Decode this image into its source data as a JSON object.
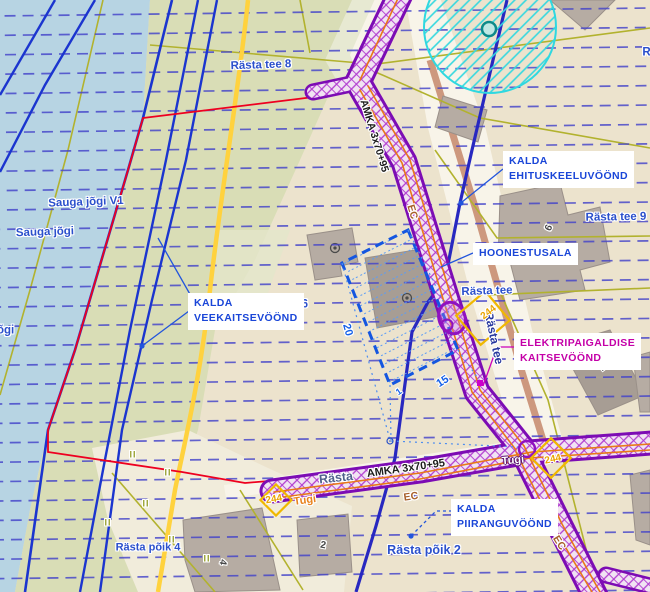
{
  "palette": {
    "water": "#b7d4e3",
    "vegetation": "#d9ddb6",
    "ground": "#ece3cd",
    "road_white": "#f8f4e9",
    "corridor_purple": "#7c0cb4",
    "cable_orange": "#e87818",
    "boundary_red": "#ee0020",
    "zone_line_navy": "#2828c0",
    "parcel_olive": "#b2b22e",
    "main_line_yellow": "#ffd23e",
    "well_zone_cyan": "#2fd8e0",
    "label_blue": "#1a46d8",
    "label_magenta": "#c400a8",
    "contour_blue": "#1b35cf",
    "hoonestusala_blue": "#1456e0"
  },
  "map": {
    "annotations": [
      {
        "id": "kalda-ehituskeeluvoond-label",
        "lines": [
          "KALDA",
          "EHITUSKEELUVÖÖND"
        ],
        "x": 503,
        "y": 151,
        "color": "#1a46d8"
      },
      {
        "id": "hoonestusala-label",
        "lines": [
          "HOONESTUSALA"
        ],
        "x": 473,
        "y": 243,
        "color": "#1a46d8"
      },
      {
        "id": "kalda-veekaitsevoond-label",
        "lines": [
          "KALDA",
          "VEEKAITSEVÖÖND"
        ],
        "x": 188,
        "y": 293,
        "color": "#1a46d8"
      },
      {
        "id": "kalda-piiranguvoond-label",
        "lines": [
          "KALDA",
          "PIIRANGUVÖÖND"
        ],
        "x": 451,
        "y": 499,
        "color": "#1a46d8"
      },
      {
        "id": "elektripaigaldise-kaitsevoond-label",
        "lines": [
          "ELEKTRIPAIGALDISE",
          "KAITSEVÖÖND"
        ],
        "x": 514,
        "y": 333,
        "color": "#c400a8"
      }
    ],
    "place_labels": [
      {
        "id": "rasta-tee-8-label",
        "text": "Rästa tee 8",
        "x": 261,
        "y": 66,
        "rot": -2,
        "size": 11.5,
        "cls": "street"
      },
      {
        "id": "rasta-tee-9-label",
        "text": "Rästa tee 9",
        "x": 616,
        "y": 218,
        "rot": -1,
        "size": 11.5,
        "cls": "street"
      },
      {
        "id": "rasta-tee-clipped-label",
        "text": "Rästa tee",
        "x": 668,
        "y": 53,
        "rot": 0,
        "size": 11.5,
        "cls": "street"
      },
      {
        "id": "sauga-jogi-v1-label",
        "text": "Sauga jõgi V1",
        "x": 86,
        "y": 203,
        "rot": -2,
        "size": 11.5,
        "cls": "street"
      },
      {
        "id": "sauga-jogi-label",
        "text": "Sauga jõgi",
        "x": 45,
        "y": 233,
        "rot": -2,
        "size": 11.5,
        "cls": "street"
      },
      {
        "id": "jogi-clipped-label",
        "text": "jõgi",
        "x": 4,
        "y": 331,
        "rot": 0,
        "size": 11.5,
        "cls": "street"
      },
      {
        "id": "rasta-tee-6-label",
        "text": "e 6",
        "x": 300,
        "y": 305,
        "rot": 0,
        "size": 11.5,
        "cls": "street"
      },
      {
        "id": "rasta-poik-4-label",
        "text": "Rästa põik 4",
        "x": 148,
        "y": 548,
        "rot": 0,
        "size": 11,
        "cls": "street"
      },
      {
        "id": "rasta-poik-2-label",
        "text": "Rästa põik 2",
        "x": 424,
        "y": 550,
        "rot": 0,
        "size": 12.5,
        "cls": "street"
      },
      {
        "id": "rasta-tee-label",
        "text": "Rästa tee",
        "x": 487,
        "y": 292,
        "rot": -2,
        "size": 11.5,
        "cls": "street"
      },
      {
        "id": "rasta-tee-vertical-label",
        "text": "Rästa tee",
        "x": 494,
        "y": 338,
        "rot": 78,
        "size": 12,
        "cls": "street-navy"
      },
      {
        "id": "rasta-street-bottom-label",
        "text": "Rästa",
        "x": 336,
        "y": 478,
        "rot": -6,
        "size": 12.5,
        "cls": "street-slate"
      }
    ],
    "utility_labels": [
      {
        "id": "cable-type-diagonal-label",
        "text": "AMKA 3x70+95",
        "x": 374,
        "y": 136,
        "rot": 73,
        "size": 10.5,
        "cls": "black"
      },
      {
        "id": "cable-type-bottom-label",
        "text": "AMKA 3x70+95",
        "x": 406,
        "y": 469,
        "rot": -8,
        "size": 11,
        "cls": "black"
      },
      {
        "id": "ec-marker-1",
        "text": "EC",
        "x": 412,
        "y": 212,
        "rot": 73,
        "size": 10.5,
        "cls": "ec"
      },
      {
        "id": "ec-marker-2",
        "text": "EC",
        "x": 411,
        "y": 497,
        "rot": -8,
        "size": 10.5,
        "cls": "ec"
      },
      {
        "id": "ec-marker-3",
        "text": "EC",
        "x": 559,
        "y": 543,
        "rot": 58,
        "size": 10.5,
        "cls": "ec"
      },
      {
        "id": "tugi-marker-1",
        "text": "Tugi",
        "x": 305,
        "y": 501,
        "rot": -8,
        "size": 11,
        "cls": "tugi"
      },
      {
        "id": "tugi-marker-2",
        "text": "Tugi",
        "x": 513,
        "y": 461,
        "rot": -5,
        "size": 11,
        "cls": "tugi-light"
      },
      {
        "id": "pole-244-1",
        "text": "244",
        "x": 274,
        "y": 500,
        "rot": -10,
        "size": 10,
        "cls": "n244"
      },
      {
        "id": "pole-244-2",
        "text": "244",
        "x": 489,
        "y": 313,
        "rot": -38,
        "size": 10,
        "cls": "n244"
      },
      {
        "id": "pole-244-3",
        "text": "244",
        "x": 553,
        "y": 460,
        "rot": -12,
        "size": 10,
        "cls": "n244"
      }
    ],
    "dimension_labels": [
      {
        "id": "dimension-20",
        "text": "20",
        "x": 347,
        "y": 330,
        "rot": 75,
        "size": 11,
        "cls": "dim"
      },
      {
        "id": "dimension-15",
        "text": "15",
        "x": 443,
        "y": 382,
        "rot": -33,
        "size": 11,
        "cls": "dim"
      },
      {
        "id": "dimension-1",
        "text": "1",
        "x": 399,
        "y": 392,
        "rot": -35,
        "size": 9,
        "cls": "dim"
      }
    ],
    "building_markers": [
      {
        "id": "building-number-9",
        "text": "9",
        "x": 547,
        "y": 227,
        "rot": 115,
        "size": 10,
        "cls": "bmark"
      },
      {
        "id": "building-number-1",
        "text": "1",
        "x": 603,
        "y": 368,
        "rot": -40,
        "size": 10,
        "cls": "bmark"
      },
      {
        "id": "building-number-4",
        "text": "4",
        "x": 222,
        "y": 562,
        "rot": 100,
        "size": 10,
        "cls": "bmark"
      },
      {
        "id": "building-number-2",
        "text": "2",
        "x": 323,
        "y": 546,
        "rot": 10,
        "size": 10,
        "cls": "bmark"
      }
    ],
    "vegetation_marks": {
      "symbol": "II",
      "points": [
        [
          133,
          455
        ],
        [
          168,
          473
        ],
        [
          146,
          504
        ],
        [
          108,
          523
        ],
        [
          172,
          540
        ],
        [
          207,
          559
        ]
      ]
    }
  }
}
